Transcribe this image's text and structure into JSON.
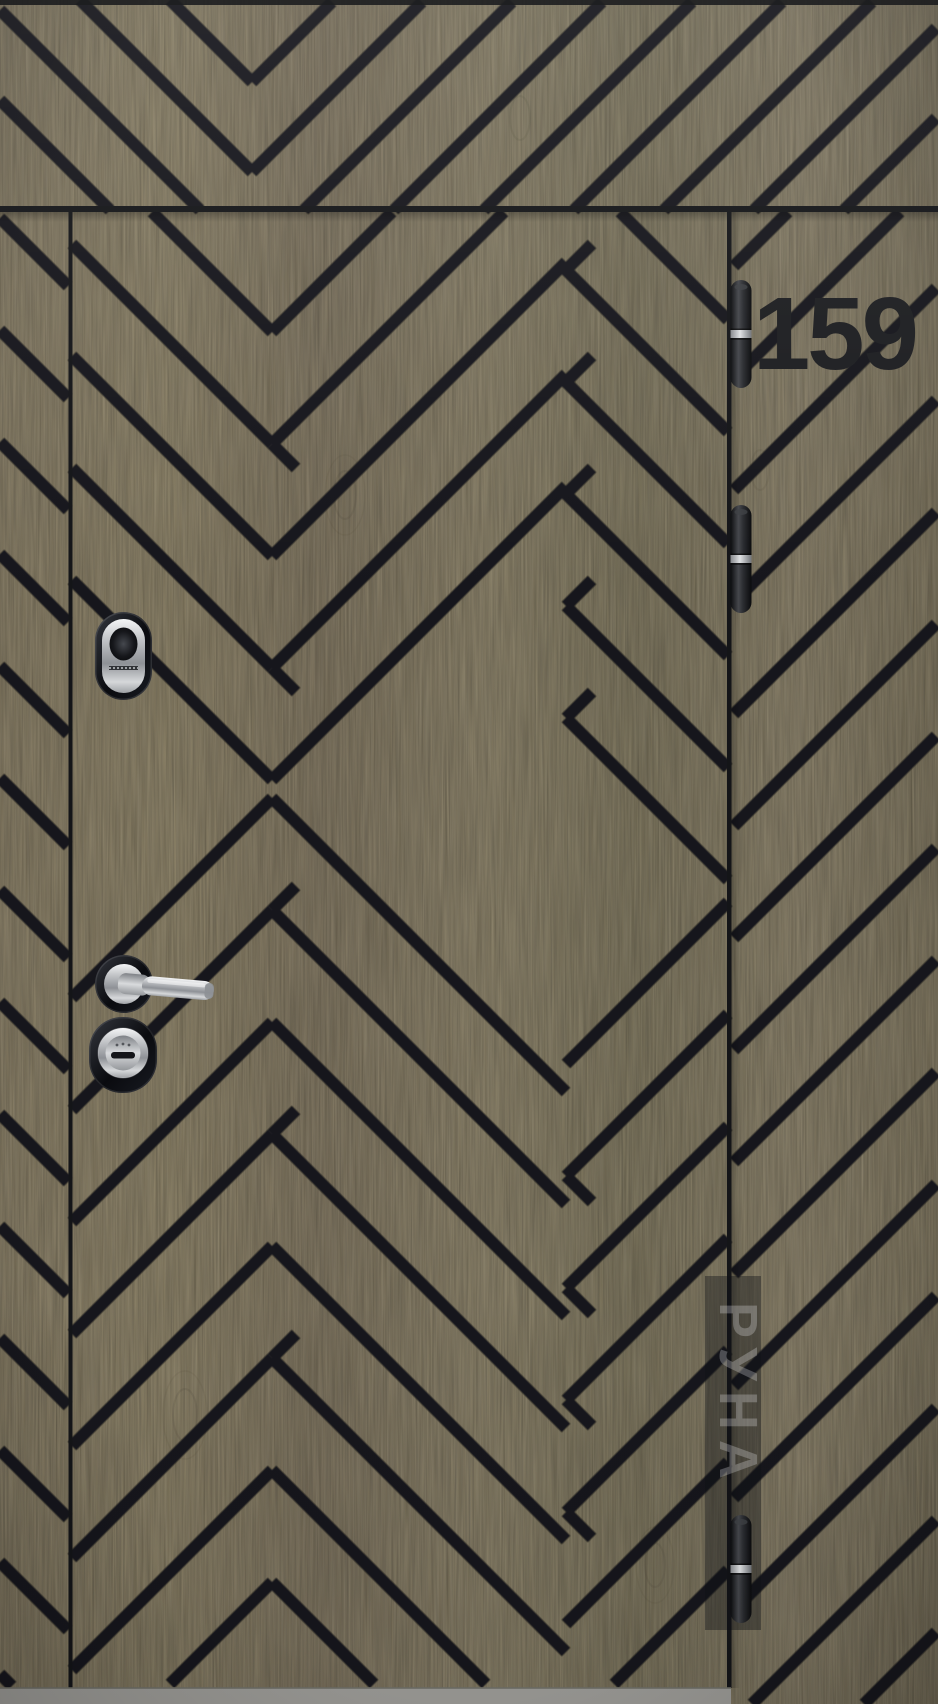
{
  "photo": {
    "house_number": "159",
    "watermark_text": "РУНА",
    "hinge_count": 3,
    "hardware": [
      "cylinder-escutcheon",
      "lever-handle",
      "deadbolt-escutcheon"
    ],
    "colors": {
      "wood": "#8c8064",
      "wood_light": "#9a8e70",
      "wood_dark": "#786d52",
      "groove": "#17181b",
      "frame_line": "#141518",
      "number": "#1d1e21",
      "hinge_band": "#c9cbce",
      "chrome_light": "#eff0f1",
      "chrome_dark": "#6f7277",
      "hardware_ring": "#0c0e13",
      "threshold": "#9c9b97",
      "watermark_strip": "rgba(16,18,23,0.40)",
      "watermark_text_color": "rgba(232,234,237,0.28)"
    }
  }
}
